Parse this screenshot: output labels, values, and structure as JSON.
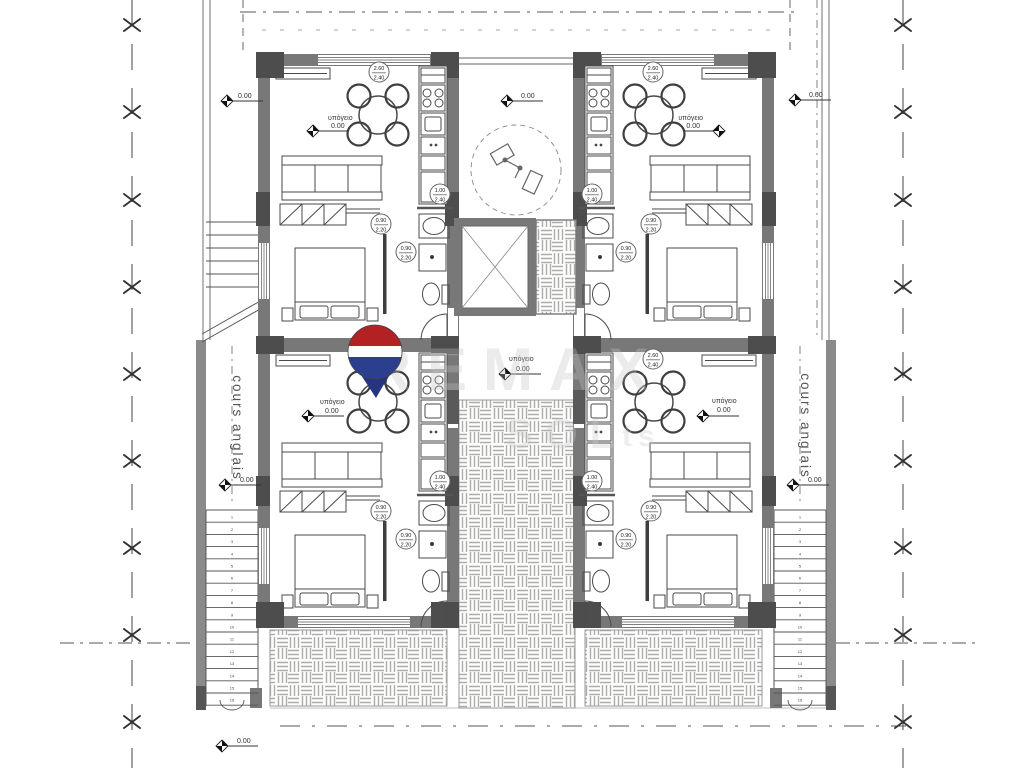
{
  "plan": {
    "level": "0.00",
    "basement": "υπόγειο",
    "light_well": "cours anglais"
  },
  "dims": {
    "window_large": {
      "w": "2.60",
      "h": "2.40"
    },
    "window_small": {
      "w": "1.00",
      "h": "2.40"
    },
    "door": {
      "w": "0.90",
      "h": "2.20"
    }
  },
  "watermark": {
    "brand": "REMAX",
    "fragment1": "SOL",
    "fragment2": "ts"
  },
  "stairs": {
    "left_steps": 16,
    "right_steps": 16,
    "upper_steps": 6
  },
  "logo_colors": {
    "red": "#b22222",
    "white": "#fdfdfd",
    "blue": "#2b3f8e"
  }
}
